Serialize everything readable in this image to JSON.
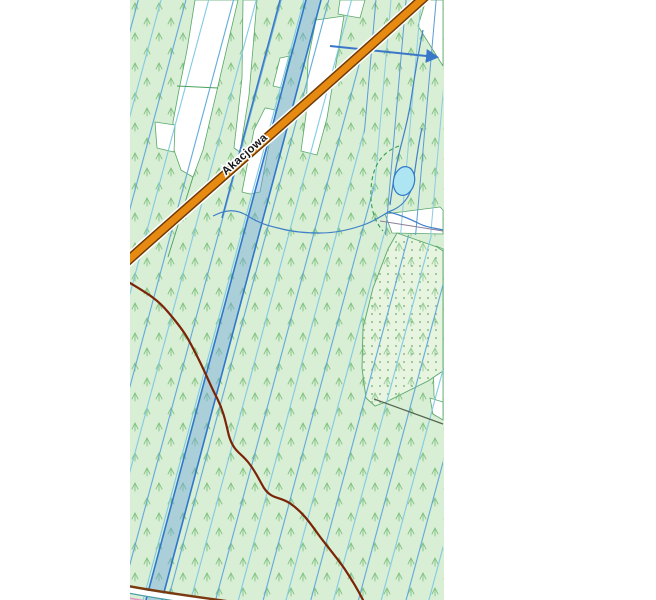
{
  "map": {
    "street_label": "Akacjowa",
    "palette": {
      "forest_fill_green": "#d8eed5",
      "tree_symbol_green": "#84c284",
      "clearing_white": "#ffffff",
      "parcel_line_steel_blue": "#5fa8d8",
      "parcel_line_cyan": "#7fc9e2",
      "ditch_dark_blue": "#2e77cc",
      "channel_fill_blue": "#a9cbe3",
      "road_fill_orange": "#e78a12",
      "road_casing_brown": "#6e3b08",
      "pond_fill_cyan": "#ade6f2",
      "boundary_meander_dark_red": "#7c2407",
      "dashed_boundary_green": "#2e9e50",
      "dotted_area_fill": "#e6f4e0",
      "utility_line_purple": "#8a7f9a",
      "bottom_line_teal": "#4a9ba8",
      "bottom_line_pink": "#e896c8"
    }
  }
}
